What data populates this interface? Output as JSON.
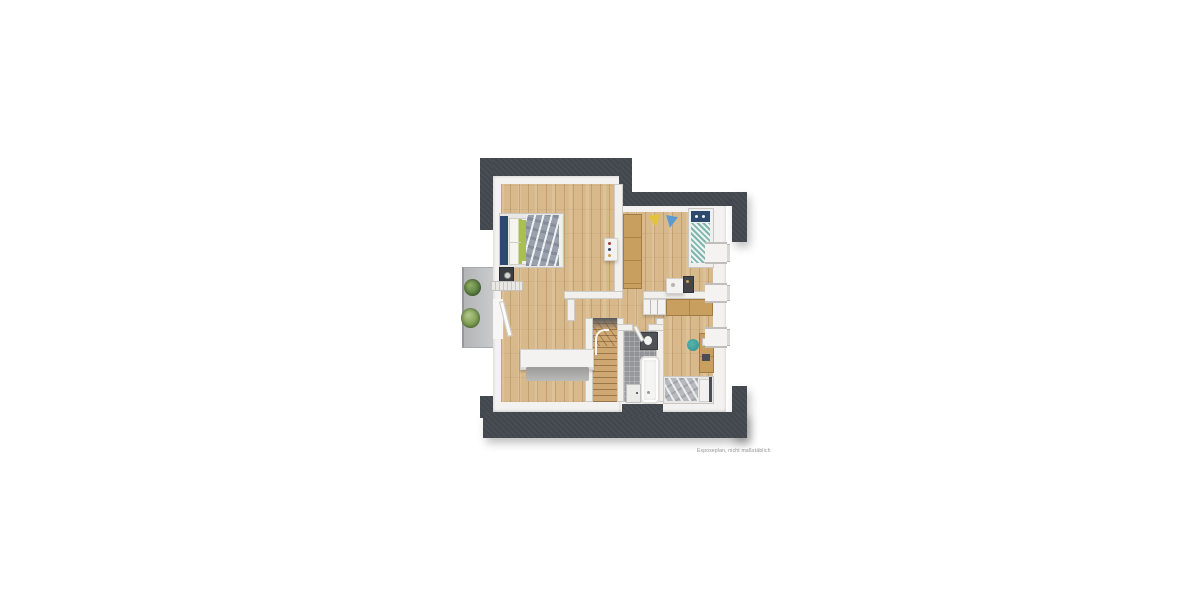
{
  "disclaimer": {
    "text": "Exposeplan, nicht maßstäblich"
  },
  "palette": {
    "roof": "#42464d",
    "wall": "#f3f2f0",
    "wallinner": "#f1f0ed",
    "wood": "#d8b98b",
    "tile": "#97999c",
    "balcony": "#c8c9cb",
    "navy": "#2c4a6e",
    "green": "#a9bf4e",
    "teal": "#7fb5ae",
    "yellow": "#e3c23c",
    "blue": "#5b9bd0",
    "tan": "#c99f5f",
    "chairteal": "#3f9d99",
    "duvetgray": "#9aa1ad",
    "bedgray": "#b6b9bd",
    "dark": "#3a3d42"
  },
  "elements": {
    "icons": [
      "double-bed-icon",
      "nightstand-lamp-icon",
      "radiator-icon",
      "wall-shelf-icon",
      "wardrobe-icon",
      "pennant-yellow-icon",
      "pennant-blue-icon",
      "single-bed-icon",
      "kids-desk-icon",
      "pinboard-icon",
      "dresser-icon",
      "counter-icon",
      "desk-icon",
      "desk-chair-icon",
      "teen-bed-icon",
      "bathtub-icon",
      "washbasin-icon",
      "shower-door-icon",
      "staircase-icon",
      "sideboard-icon",
      "rug-icon",
      "balcony-plant-icon",
      "balcony-door-icon",
      "window-icon"
    ]
  }
}
